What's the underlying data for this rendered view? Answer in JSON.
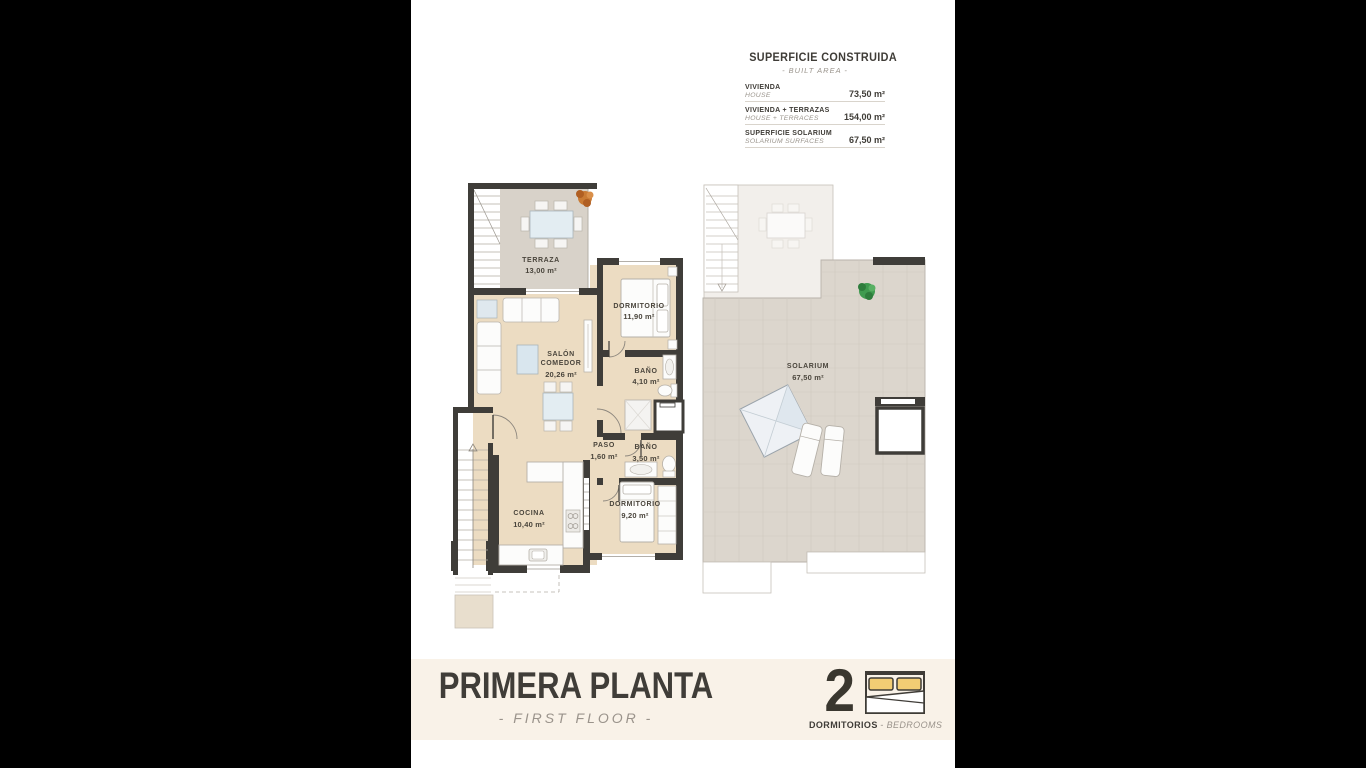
{
  "colors": {
    "letterbox": "#000000",
    "page_bg": "#ffffff",
    "wall": "#3f3d39",
    "floor_interior": "#ecdcc2",
    "floor_terrace": "#d8d2c9",
    "floor_solarium": "#dcd6cd",
    "floor_ghost": "#f2efeb",
    "footer_band": "#f9f2e8",
    "accent_text": "#3f3c37",
    "muted_text": "#9a948c",
    "pillow_yellow": "#f2cd74",
    "plant_green": "#3f9b4f",
    "plant_orange": "#c97b35",
    "furniture_blue": "#dfe9ef"
  },
  "stats": {
    "title": "SUPERFICIE CONSTRUIDA",
    "subtitle": "- BUILT AREA -",
    "rows": [
      {
        "label": "VIVIENDA",
        "sublabel": "HOUSE",
        "value": "73,50 m²"
      },
      {
        "label": "VIVIENDA + TERRAZAS",
        "sublabel": "HOUSE + TERRACES",
        "value": "154,00 m²"
      },
      {
        "label": "SUPERFICIE SOLARIUM",
        "sublabel": "SOLARIUM SURFACES",
        "value": "67,50 m²"
      }
    ]
  },
  "rooms": {
    "terraza": {
      "name": "TERRAZA",
      "area": "13,00 m²"
    },
    "dormitorio1": {
      "name": "DORMITORIO",
      "area": "11,90 m²"
    },
    "salon": {
      "name1": "SALÓN",
      "name2": "COMEDOR",
      "area": "20,26 m²"
    },
    "bano1": {
      "name": "BAÑO",
      "area": "4,10 m²"
    },
    "paso": {
      "name": "PASO",
      "area": "1,60 m²"
    },
    "bano2": {
      "name": "BAÑO",
      "area": "3,50 m²"
    },
    "cocina": {
      "name": "COCINA",
      "area": "10,40 m²"
    },
    "dormitorio2": {
      "name": "DORMITORIO",
      "area": "9,20 m²"
    },
    "solarium": {
      "name": "SOLARIUM",
      "area": "67,50 m²"
    }
  },
  "footer": {
    "title": "PRIMERA PLANTA",
    "subtitle": "- FIRST FLOOR -",
    "bedrooms_count": "2",
    "bedrooms_label": "DORMITORIOS",
    "bedrooms_sublabel": "- BEDROOMS"
  }
}
